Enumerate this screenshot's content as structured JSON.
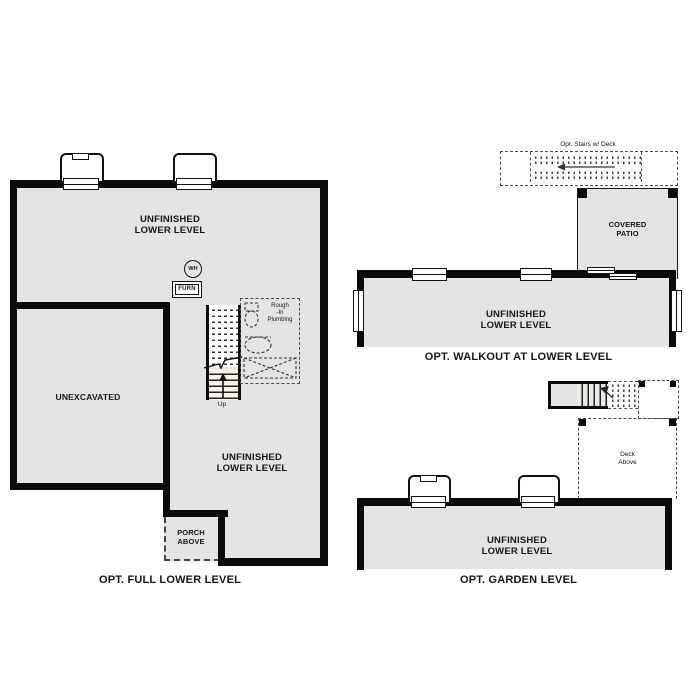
{
  "colors": {
    "floor": "#e6e4e2",
    "wall": "#0b0b0b",
    "stair": "#f9f4e8"
  },
  "full_lower": {
    "room_upper": "UNFINISHED\nLOWER LEVEL",
    "water_heater": "WH",
    "furnace": "FURN",
    "unexcavated": "UNEXCAVATED",
    "stairs_up": "Up",
    "rough_in_plumbing": "Rough\n-In\nPlumbing",
    "room_lower": "UNFINISHED\nLOWER LEVEL",
    "porch": "PORCH\nABOVE",
    "caption": "OPT. FULL LOWER LEVEL"
  },
  "walkout": {
    "opt_stairs": "Opt. Stairs w/ Deck",
    "covered_patio": "COVERED\nPATIO",
    "room": "UNFINISHED\nLOWER LEVEL",
    "caption": "OPT. WALKOUT AT LOWER LEVEL"
  },
  "garden": {
    "deck_above": "Deck\nAbove",
    "room": "UNFINISHED\nLOWER LEVEL",
    "caption": "OPT. GARDEN LEVEL"
  }
}
